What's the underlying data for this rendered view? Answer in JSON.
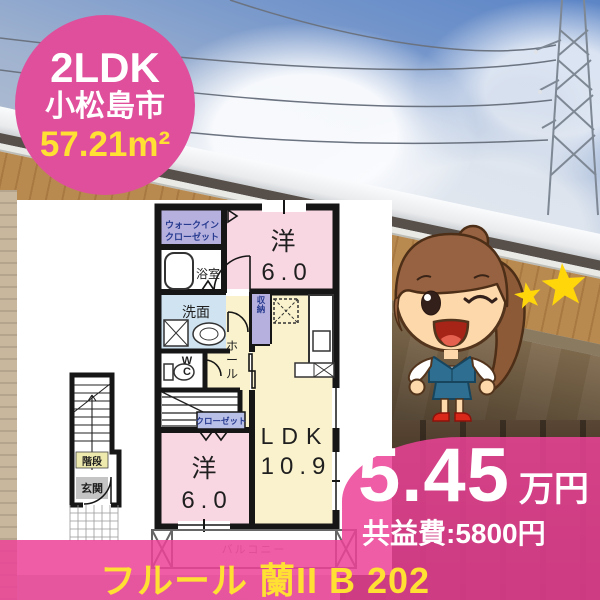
{
  "badge": {
    "layout": "2LDK",
    "city": "小松島市",
    "area": "57.21m²"
  },
  "floorplan": {
    "wic_line1": "ウォークイン",
    "wic_line2": "クローゼット",
    "bath": "浴室",
    "washroom": "洗面",
    "wc": "WC",
    "storage": "収納",
    "hall": "ホール",
    "room1_name": "洋",
    "room1_size": "6.0",
    "ldk_name": "LDK",
    "ldk_size": "10.9",
    "closet": "クローゼット",
    "room2_name": "洋",
    "room2_size": "6.0",
    "stairs": "階段",
    "entrance": "玄関",
    "balcony": "バルコニー"
  },
  "price": {
    "rent": "5.45",
    "unit": "万円",
    "fee": "共益費:5800円"
  },
  "footer": {
    "name": "フルール 蘭II B 202"
  },
  "icons": {
    "mascot": "real-estate-agent-mascot",
    "star_large": "star-icon",
    "star_small": "star-icon",
    "tower": "transmission-tower"
  },
  "colors": {
    "badge_pink": "#df4f9b",
    "overlay_pink": "#eb4296",
    "accent_yellow": "#ffe033",
    "star_yellow": "#ffd60a",
    "plan_pink": "#f8d7e3",
    "plan_yellow": "#f9f2cc",
    "plan_lavender": "#b5b0de",
    "plan_blue": "#cfe3f1"
  }
}
